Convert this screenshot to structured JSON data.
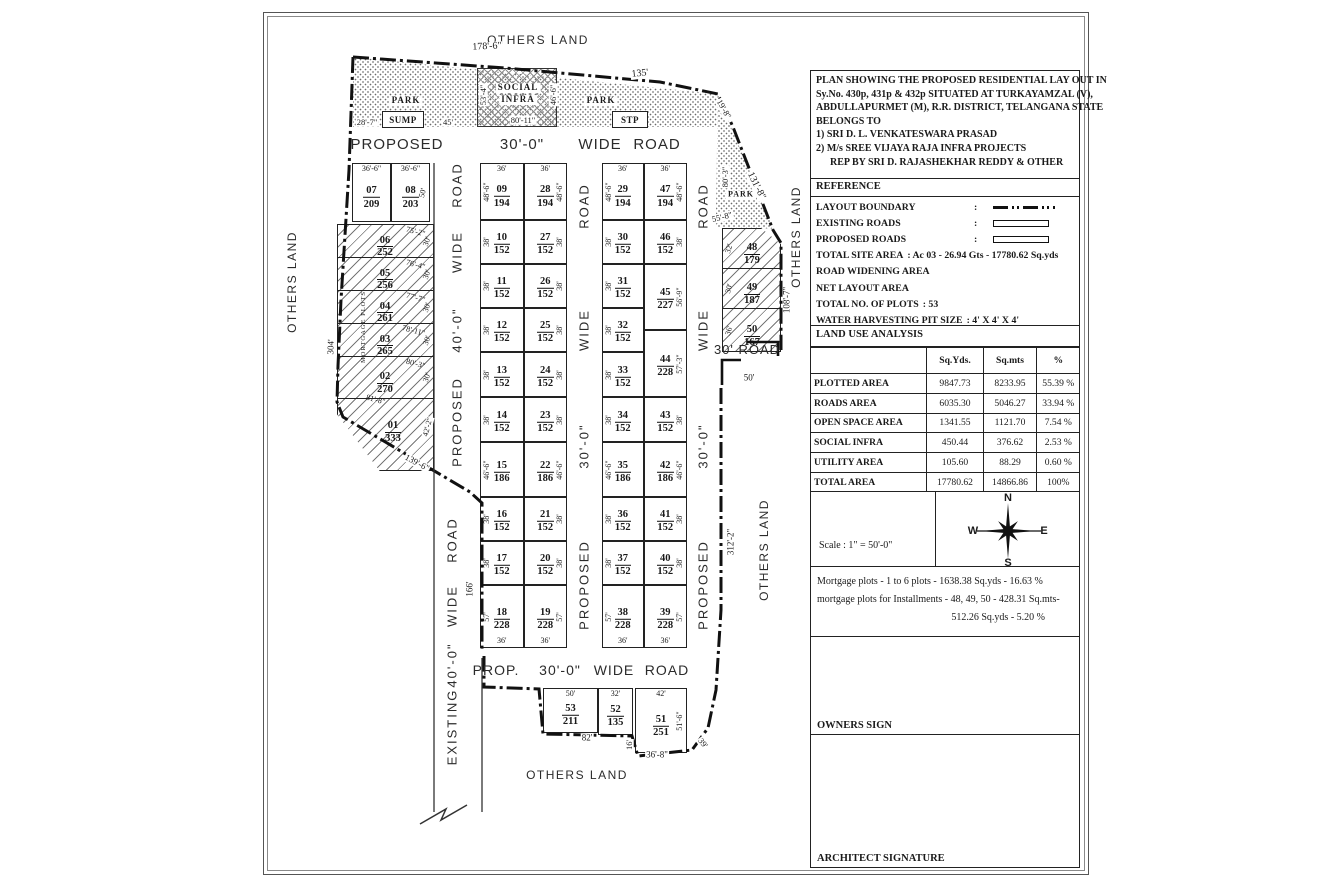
{
  "title_block": {
    "description_lines": [
      "PLAN SHOWING THE PROPOSED RESIDENTIAL LAY OUT IN",
      "Sy.No. 430p, 431p & 432p SITUATED AT TURKAYAMZAL (V),",
      "ABDULLAPURMET (M), R.R. DISTRICT, TELANGANA STATE",
      "BELONGS TO",
      "1) SRI D. L. VENKATESWARA PRASAD",
      "2) M/s SREE VIJAYA RAJA INFRA PROJECTS",
      "REP BY SRI D. RAJASHEKHAR REDDY & OTHER"
    ],
    "reference": {
      "header": "REFERENCE",
      "items": [
        {
          "label": "LAYOUT BOUNDARY",
          "colon": ":",
          "symbol": "dashdot"
        },
        {
          "label": "EXISTING ROADS",
          "colon": ":",
          "symbol": "bar"
        },
        {
          "label": "PROPOSED ROADS",
          "colon": ":",
          "symbol": "bar"
        },
        {
          "label": "TOTAL SITE AREA",
          "value": ": Ac 03 - 26.94 Gts - 17780.62 Sq.yds"
        },
        {
          "label": "ROAD WIDENING AREA",
          "value": ""
        },
        {
          "label": "NET LAYOUT AREA",
          "value": ""
        },
        {
          "label": "TOTAL NO. OF PLOTS",
          "value": ": 53"
        },
        {
          "label": "WATER HARVESTING PIT SIZE",
          "value": ": 4' X 4' X 4'"
        }
      ]
    },
    "land_use": {
      "header": "LAND USE ANALYSIS",
      "columns": [
        "",
        "Sq.Yds.",
        "Sq.mts",
        "%"
      ],
      "rows": [
        [
          "PLOTTED AREA",
          "9847.73",
          "8233.95",
          "55.39 %"
        ],
        [
          "ROADS AREA",
          "6035.30",
          "5046.27",
          "33.94 %"
        ],
        [
          "OPEN SPACE AREA",
          "1341.55",
          "1121.70",
          "7.54 %"
        ],
        [
          "SOCIAL INFRA",
          "450.44",
          "376.62",
          "2.53 %"
        ],
        [
          "UTILITY AREA",
          "105.60",
          "88.29",
          "0.60 %"
        ],
        [
          "TOTAL AREA",
          "17780.62",
          "14866.86",
          "100%"
        ]
      ]
    },
    "scale_text": "Scale : 1\" = 50'-0\"",
    "compass": {
      "n": "N",
      "s": "S",
      "e": "E",
      "w": "W"
    },
    "mortgage_lines": [
      "Mortgage plots - 1 to 6 plots - 1638.38 Sq.yds - 16.63 %",
      "mortgage plots for Installments - 48, 49, 50 - 428.31 Sq.mts-",
      "512.26 Sq.yds - 5.20 %"
    ],
    "owners_sign": "OWNERS SIGN",
    "architect_signature": "ARCHITECT SIGNATURE"
  },
  "plan": {
    "others_land": {
      "top": "OTHERS LAND",
      "left": "OTHERS LAND",
      "right_upper": "OTHERS LAND",
      "right_lower": "OTHERS LAND",
      "bottom": "OTHERS LAND"
    },
    "facilities": {
      "park_left": "PARK",
      "park_mid": "PARK",
      "park_right": "PARK",
      "sump": "SUMP",
      "stp": "STP",
      "social_line1": "SOCIAL",
      "social_line2": "INFRA",
      "mortgage_note": "MORTGAGE PLOTS"
    },
    "roads": {
      "top": [
        "PROPOSED",
        "30'-0\"",
        "WIDE",
        "ROAD"
      ],
      "bottom": [
        "PROP.",
        "30'-0\"",
        "WIDE",
        "ROAD"
      ],
      "left_upper": [
        "ROAD",
        "WIDE",
        "40'-0\"",
        "PROPOSED"
      ],
      "left_lower": [
        "ROAD",
        "WIDE",
        "40'-0\"",
        "EXISTING"
      ],
      "mid": [
        "ROAD",
        "WIDE",
        "30'-0\"",
        "PROPOSED"
      ],
      "right": [
        "ROAD",
        "WIDE",
        "30'-0\"",
        "PROPOSED"
      ],
      "exit_label": "30' ROAD"
    },
    "grid_columns": [
      {
        "plots": [
          {
            "no": "09",
            "area": "194",
            "side": "48'-6\"",
            "top": "36'"
          },
          {
            "no": "10",
            "area": "152",
            "side": "38'"
          },
          {
            "no": "11",
            "area": "152",
            "side": "38'"
          },
          {
            "no": "12",
            "area": "152",
            "side": "38'"
          },
          {
            "no": "13",
            "area": "152",
            "side": "38'"
          },
          {
            "no": "14",
            "area": "152",
            "side": "38'"
          },
          {
            "no": "15",
            "area": "186",
            "side": "46'-6\""
          },
          {
            "no": "16",
            "area": "152",
            "side": "38'"
          },
          {
            "no": "17",
            "area": "152",
            "side": "38'"
          },
          {
            "no": "18",
            "area": "228",
            "side": "57'",
            "bottom": "36'"
          }
        ]
      },
      {
        "plots": [
          {
            "no": "28",
            "area": "194",
            "side": "48'-6\"",
            "top": "36'"
          },
          {
            "no": "27",
            "area": "152",
            "side": "38'"
          },
          {
            "no": "26",
            "area": "152",
            "side": "38'"
          },
          {
            "no": "25",
            "area": "152",
            "side": "38'"
          },
          {
            "no": "24",
            "area": "152",
            "side": "38'"
          },
          {
            "no": "23",
            "area": "152",
            "side": "38'"
          },
          {
            "no": "22",
            "area": "186",
            "side": "46'-6\""
          },
          {
            "no": "21",
            "area": "152",
            "side": "38'"
          },
          {
            "no": "20",
            "area": "152",
            "side": "38'"
          },
          {
            "no": "19",
            "area": "228",
            "side": "57'",
            "bottom": "36'"
          }
        ]
      },
      {
        "plots": [
          {
            "no": "29",
            "area": "194",
            "side": "48'-6\"",
            "top": "36'"
          },
          {
            "no": "30",
            "area": "152",
            "side": "38'"
          },
          {
            "no": "31",
            "area": "152",
            "side": "38'"
          },
          {
            "no": "32",
            "area": "152",
            "side": "38'"
          },
          {
            "no": "33",
            "area": "152",
            "side": "38'"
          },
          {
            "no": "34",
            "area": "152",
            "side": "38'"
          },
          {
            "no": "35",
            "area": "186",
            "side": "46'-6\""
          },
          {
            "no": "36",
            "area": "152",
            "side": "38'"
          },
          {
            "no": "37",
            "area": "152",
            "side": "38'"
          },
          {
            "no": "38",
            "area": "228",
            "side": "57'",
            "bottom": "36'"
          }
        ]
      },
      {
        "plots": [
          {
            "no": "47",
            "area": "194",
            "side": "48'-6\"",
            "top": "36'"
          },
          {
            "no": "46",
            "area": "152",
            "side": "38'"
          },
          {
            "no": "45",
            "area": "227",
            "side": "56'-9\""
          },
          {
            "no": "44",
            "area": "228",
            "side": "57'-3\""
          },
          {
            "no": "43",
            "area": "152",
            "side": "38'"
          },
          {
            "no": "42",
            "area": "186",
            "side": "46'-6\""
          },
          {
            "no": "41",
            "area": "152",
            "side": "38'"
          },
          {
            "no": "40",
            "area": "152",
            "side": "38'"
          },
          {
            "no": "39",
            "area": "228",
            "side": "57'",
            "bottom": "36'"
          }
        ]
      }
    ],
    "top_pair": [
      {
        "no": "07",
        "area": "209",
        "top": "36'-6\""
      },
      {
        "no": "08",
        "area": "203",
        "top": "36'-6\"",
        "side": "50'"
      }
    ],
    "left_block": [
      {
        "no": "06",
        "area": "252",
        "slant": "75'-2\"",
        "side": "30'"
      },
      {
        "no": "05",
        "area": "256",
        "slant": "76'-4\"",
        "side": "30'"
      },
      {
        "no": "04",
        "area": "261",
        "slant": "77'-7\"",
        "side": "30'"
      },
      {
        "no": "03",
        "area": "265",
        "slant": "78'-11\"",
        "side": "30'"
      },
      {
        "no": "02",
        "area": "270",
        "slant": "80'-3\"",
        "side": "30'"
      },
      {
        "no": "01",
        "area": "333",
        "slant": "81'-8\""
      }
    ],
    "right_block": [
      {
        "no": "48",
        "area": "179",
        "side": "32'"
      },
      {
        "no": "49",
        "area": "187",
        "side": "30'"
      },
      {
        "no": "50",
        "area": "167",
        "side": "36'"
      }
    ],
    "bottom_plots": [
      {
        "no": "53",
        "area": "211",
        "top": "50'"
      },
      {
        "no": "52",
        "area": "135",
        "top": "32'"
      },
      {
        "no": "51",
        "area": "251",
        "top": "42'",
        "side": "51'-6\""
      }
    ],
    "dims": {
      "boundary_178_6": "178'-6\"",
      "boundary_135": "135'",
      "corner_19_8": "19'-8\"",
      "slant_131_8": "131'-8\"",
      "park_80_3": "80'-3\"",
      "park_55_8": "55'-8\"",
      "right_108_7": "108'-7\"",
      "right_312_2": "312'-2\"",
      "exit_50": "50'",
      "left_28_7": "28'-7\"",
      "sump_45": "45'",
      "si_53_4": "53'-4\"",
      "si_80_11": "80'-11\"",
      "si_46_6": "46'-6\"",
      "left_304": "304'",
      "slant_139_6": "139'-6\"",
      "plot01_42_2": "42'-2\"",
      "left_166": "166'",
      "bottom_82": "82'",
      "bottom_16": "16'",
      "bottom_36_8": "36'-8\"",
      "bottom_39": "39'"
    }
  }
}
